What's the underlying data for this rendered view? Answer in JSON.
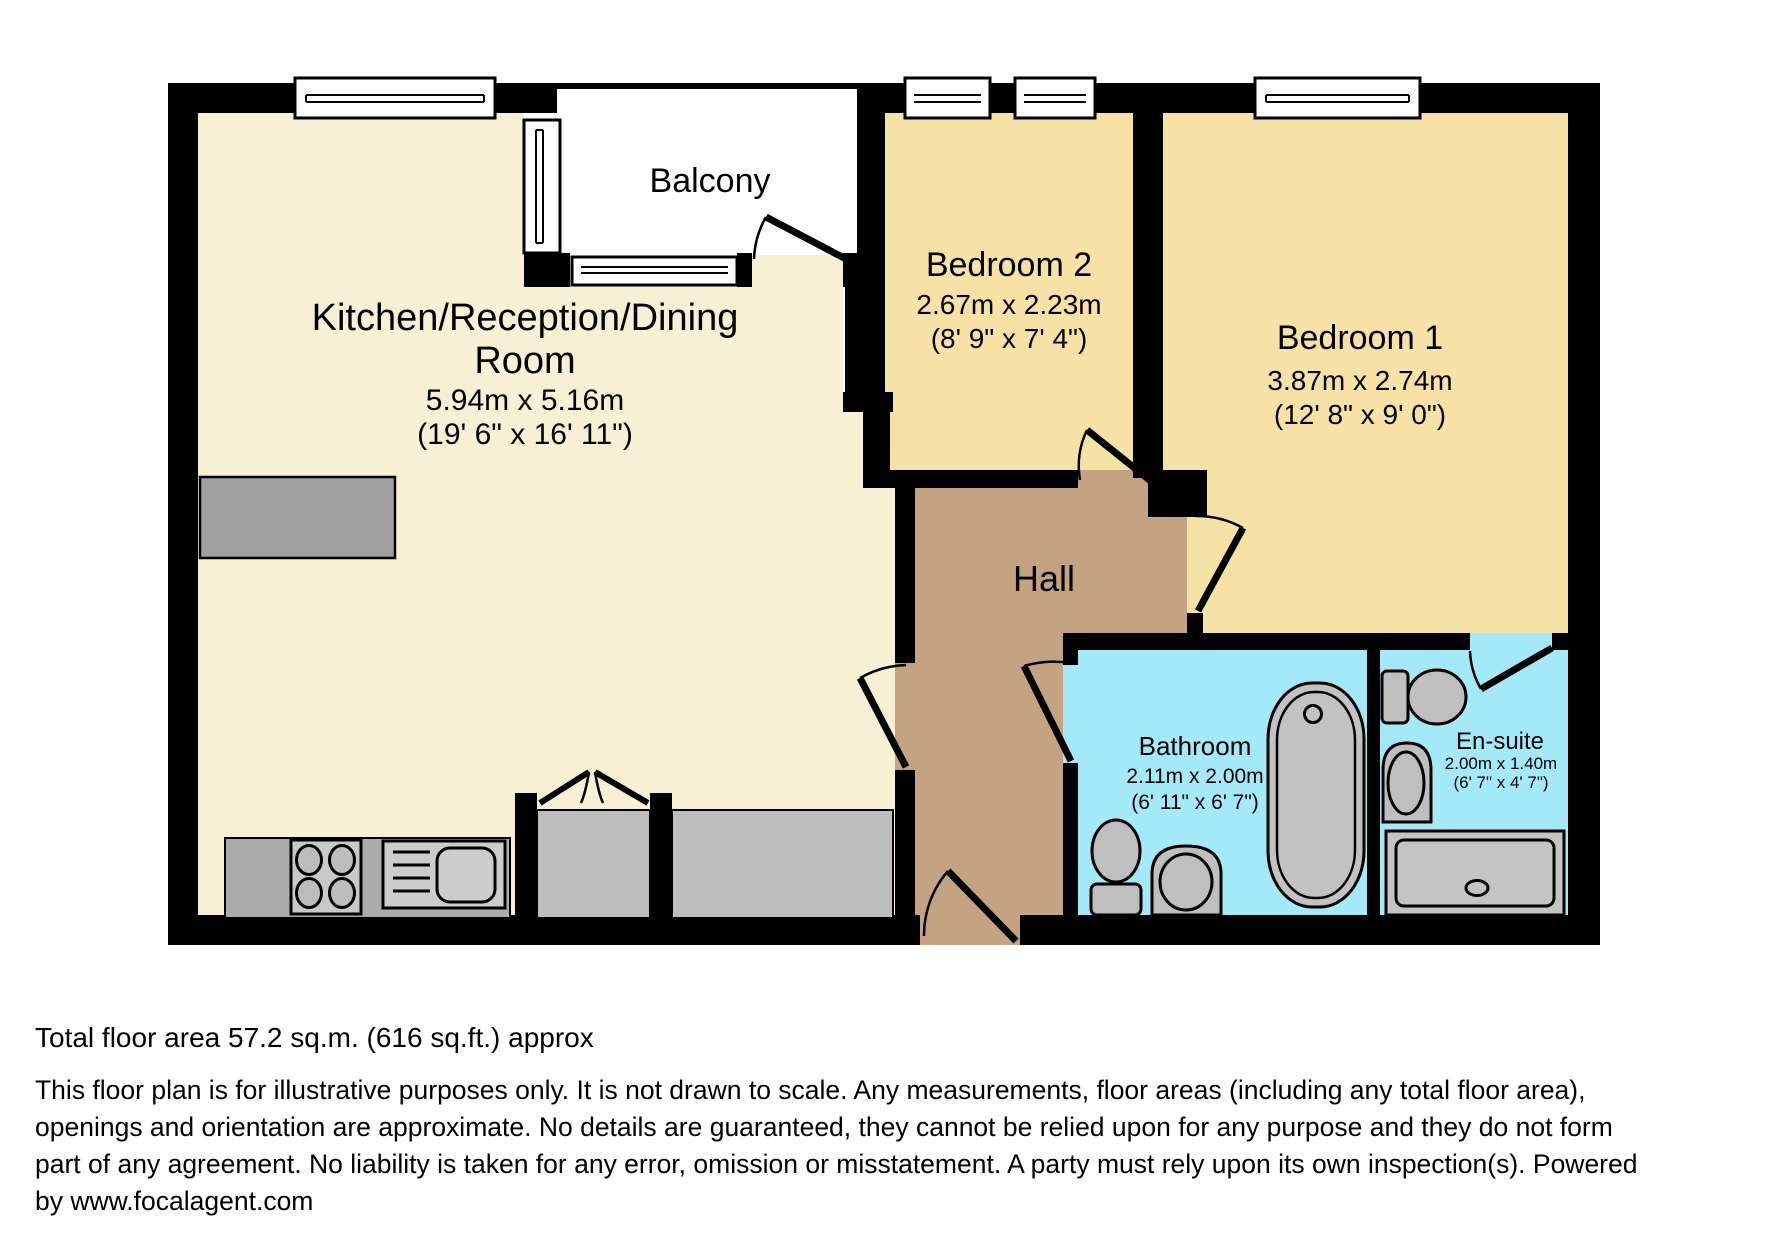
{
  "plan": {
    "balcony_label": "Balcony",
    "rooms": {
      "kitchen": {
        "name_line1": "Kitchen/Reception/Dining",
        "name_line2": "Room",
        "dims_metric": "5.94m x 5.16m",
        "dims_imperial": "(19' 6\" x 16' 11\")"
      },
      "bedroom2": {
        "name": "Bedroom 2",
        "dims_metric": "2.67m x 2.23m",
        "dims_imperial": "(8' 9\" x 7' 4\")"
      },
      "bedroom1": {
        "name": "Bedroom 1",
        "dims_metric": "3.87m x 2.74m",
        "dims_imperial": "(12' 8\" x 9' 0\")"
      },
      "hall": {
        "name": "Hall"
      },
      "bathroom": {
        "name": "Bathroom",
        "dims_metric": "2.11m x 2.00m",
        "dims_imperial": "(6' 11\" x 6' 7\")"
      },
      "ensuite": {
        "name": "En-suite",
        "dims_metric": "2.00m x 1.40m",
        "dims_imperial": "(6' 7\" x 4' 7\")"
      }
    },
    "colors": {
      "wall": "#000000",
      "kitchen": "#F7F0D5",
      "bedroom": "#F6E2A4",
      "hall": "#C4A383",
      "wet_room": "#A4E9F7",
      "balcony": "#FFFFFF",
      "fixture": "#C2C2C2",
      "fixture_dark": "#A6A6A6"
    }
  },
  "footer": {
    "total_area": "Total floor area 57.2 sq.m. (616 sq.ft.) approx",
    "disclaimer_lines": [
      "This floor plan is for illustrative purposes only. It is not drawn to scale. Any measurements, floor areas (including any total floor area),",
      "openings and orientation are approximate. No details are guaranteed, they cannot be relied upon for any purpose and they do not form",
      "part of any agreement. No liability is taken for any error, omission or misstatement. A party must rely upon its own inspection(s). Powered",
      "by www.focalagent.com"
    ]
  }
}
